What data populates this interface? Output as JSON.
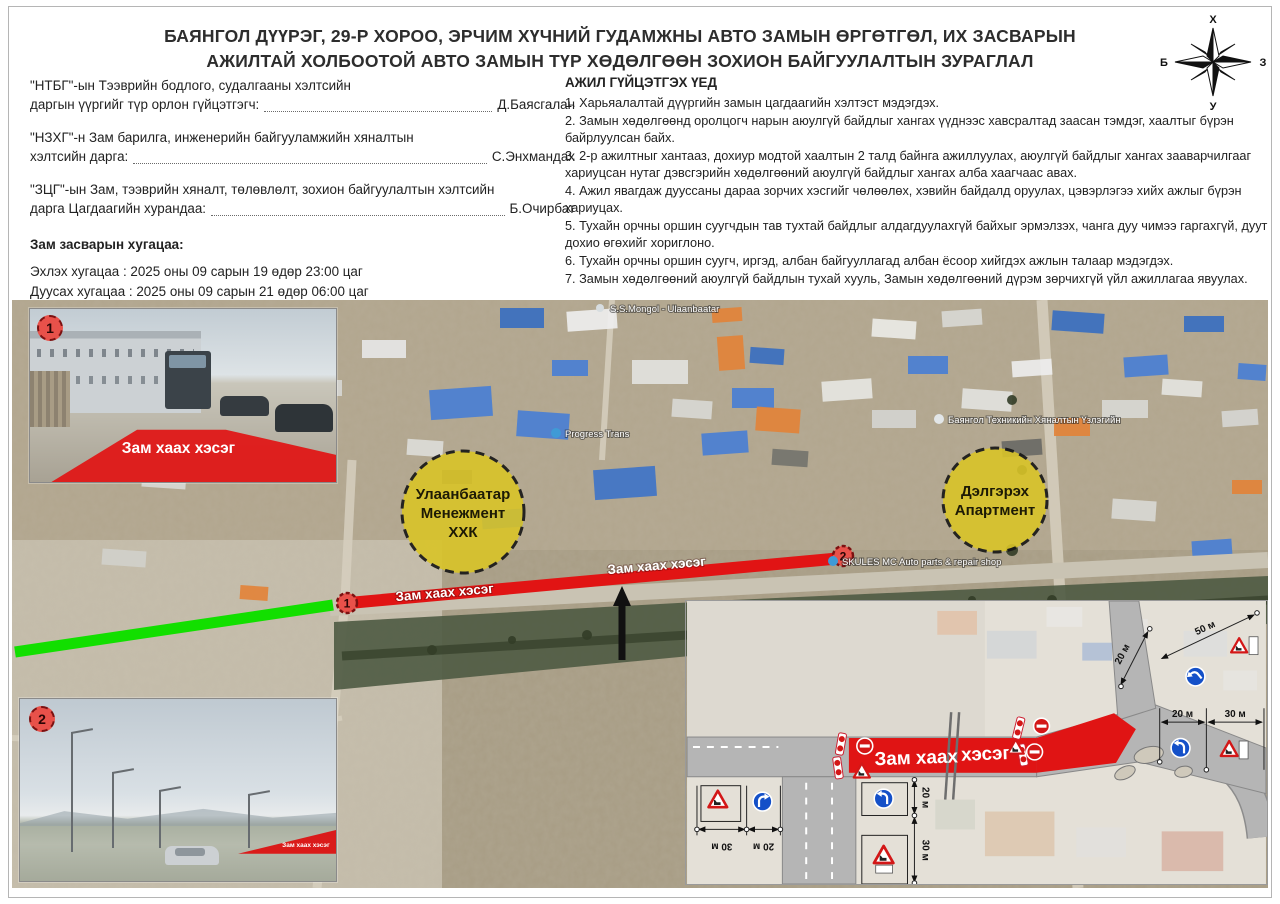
{
  "title": {
    "line1": "БАЯНГОЛ ДҮҮРЭГ, 29-Р ХОРОО, ЭРЧИМ ХҮЧНИЙ ГУДАМЖНЫ АВТО ЗАМЫН ӨРГӨТГӨЛ, ИХ ЗАСВАРЫН",
    "line2": "АЖИЛТАЙ ХОЛБООТОЙ АВТО ЗАМЫН ТҮР ХӨДӨЛГӨӨН ЗОХИОН БАЙГУУЛАЛТЫН ЗУРАГЛАЛ"
  },
  "compass": {
    "north": "Х",
    "south": "У",
    "west": "Б",
    "east": "З"
  },
  "signatories": [
    {
      "role_line1": "\"НТБГ\"-ын Тээврийн бодлого, судалгааны хэлтсийн",
      "role_line2": "даргын үүргийг түр орлон гүйцэтгэгч:",
      "name": "Д.Баясгалан"
    },
    {
      "role_line1": "\"НЗХГ\"-н Зам барилга, инженерийн байгууламжийн хяналтын",
      "role_line2": "хэлтсийн дарга:",
      "name": "С.Энхмандах"
    },
    {
      "role_line1": "\"ЗЦГ\"-ын Зам, тээврийн хяналт, төлөвлөлт, зохион байгуулалтын хэлтсийн",
      "role_line2": "дарга Цагдаагийн хурандаа:",
      "name": "Б.Очирбат"
    }
  ],
  "schedule": {
    "heading": "Зам засварын хугацаа:",
    "start": "Эхлэх хугацаа : 2025 оны 09 сарын 19 өдөр 23:00 цаг",
    "end": "Дуусах хугацаа : 2025 оны 09 сарын 21 өдөр 06:00 цаг"
  },
  "work_instructions": {
    "heading": "АЖИЛ ГҮЙЦЭТГЭХ ҮЕД",
    "items": [
      "1.  Харьяалалтай дүүргийн замын цагдаагийн хэлтэст мэдэгдэх.",
      "2.  Замын хөдөлгөөнд оролцогч нарын аюулгүй байдлыг хангах үүднээс хавсралтад заасан тэмдэг, хаалтыг бүрэн байрлуулсан байх.",
      "3.  2-р ажилтныг хантааз, дохиур модтой хаалтын 2 талд байнга ажиллуулах, аюулгүй байдлыг хангах зааварчилгааг хариуцсан нутаг дэвсгэрийн хөдөлгөөний аюулгүй байдлыг хангах алба хаагчаас авах.",
      "4.  Ажил явагдаж дууссаны дараа зорчих хэсгийг чөлөөлөх, хэвийн байдалд оруулах, цэвэрлэгээ хийх ажлыг бүрэн хариуцах.",
      "5.  Тухайн орчны оршин суугчдын тав тухтай байдлыг алдагдуулахгүй байхыг эрмэлзэх, чанга дуу чимээ гаргахгүй, дуут дохио өгөхийг хориглоно.",
      "6.  Тухайн орчны оршин суугч, иргэд, албан байгууллагад албан ёсоор хийгдэх ажлын талаар мэдэгдэх.",
      "7.  Замын хөдөлгөөний аюулгүй байдлын тухай хууль, Замын хөдөлгөөний дүрэм зөрчихгүй үйл ажиллагаа явуулах."
    ],
    "received_label": "Зааварчилгаа хүлээн авсан:"
  },
  "map": {
    "closure_label": "Зам хаах хэсэг",
    "markers": {
      "one": "1",
      "two": "2"
    },
    "zones": [
      {
        "line1": "Улаанбаатар",
        "line2": "Менежмент",
        "line3": "ХХК"
      },
      {
        "line1": "Дэлгэрэх",
        "line2": "Апартмент"
      }
    ],
    "poi": [
      "S.S.Mongol - Ulaanbaatar",
      "Progress Trans",
      "Баянгол Техникийн Хяналтын Үзлэгийн",
      "SKULES MC Auto parts & repair shop"
    ]
  },
  "diagram": {
    "label_part1": "Зам хаах",
    "label_part2": "хэсэг",
    "dims": {
      "d20": "20 м",
      "d30": "30 м",
      "d50": "50 м"
    }
  },
  "colors": {
    "closure_red": "#e11414",
    "open_green": "#12df00",
    "zone_yellow": "#d9c428",
    "sign_blue": "#1450c8"
  }
}
